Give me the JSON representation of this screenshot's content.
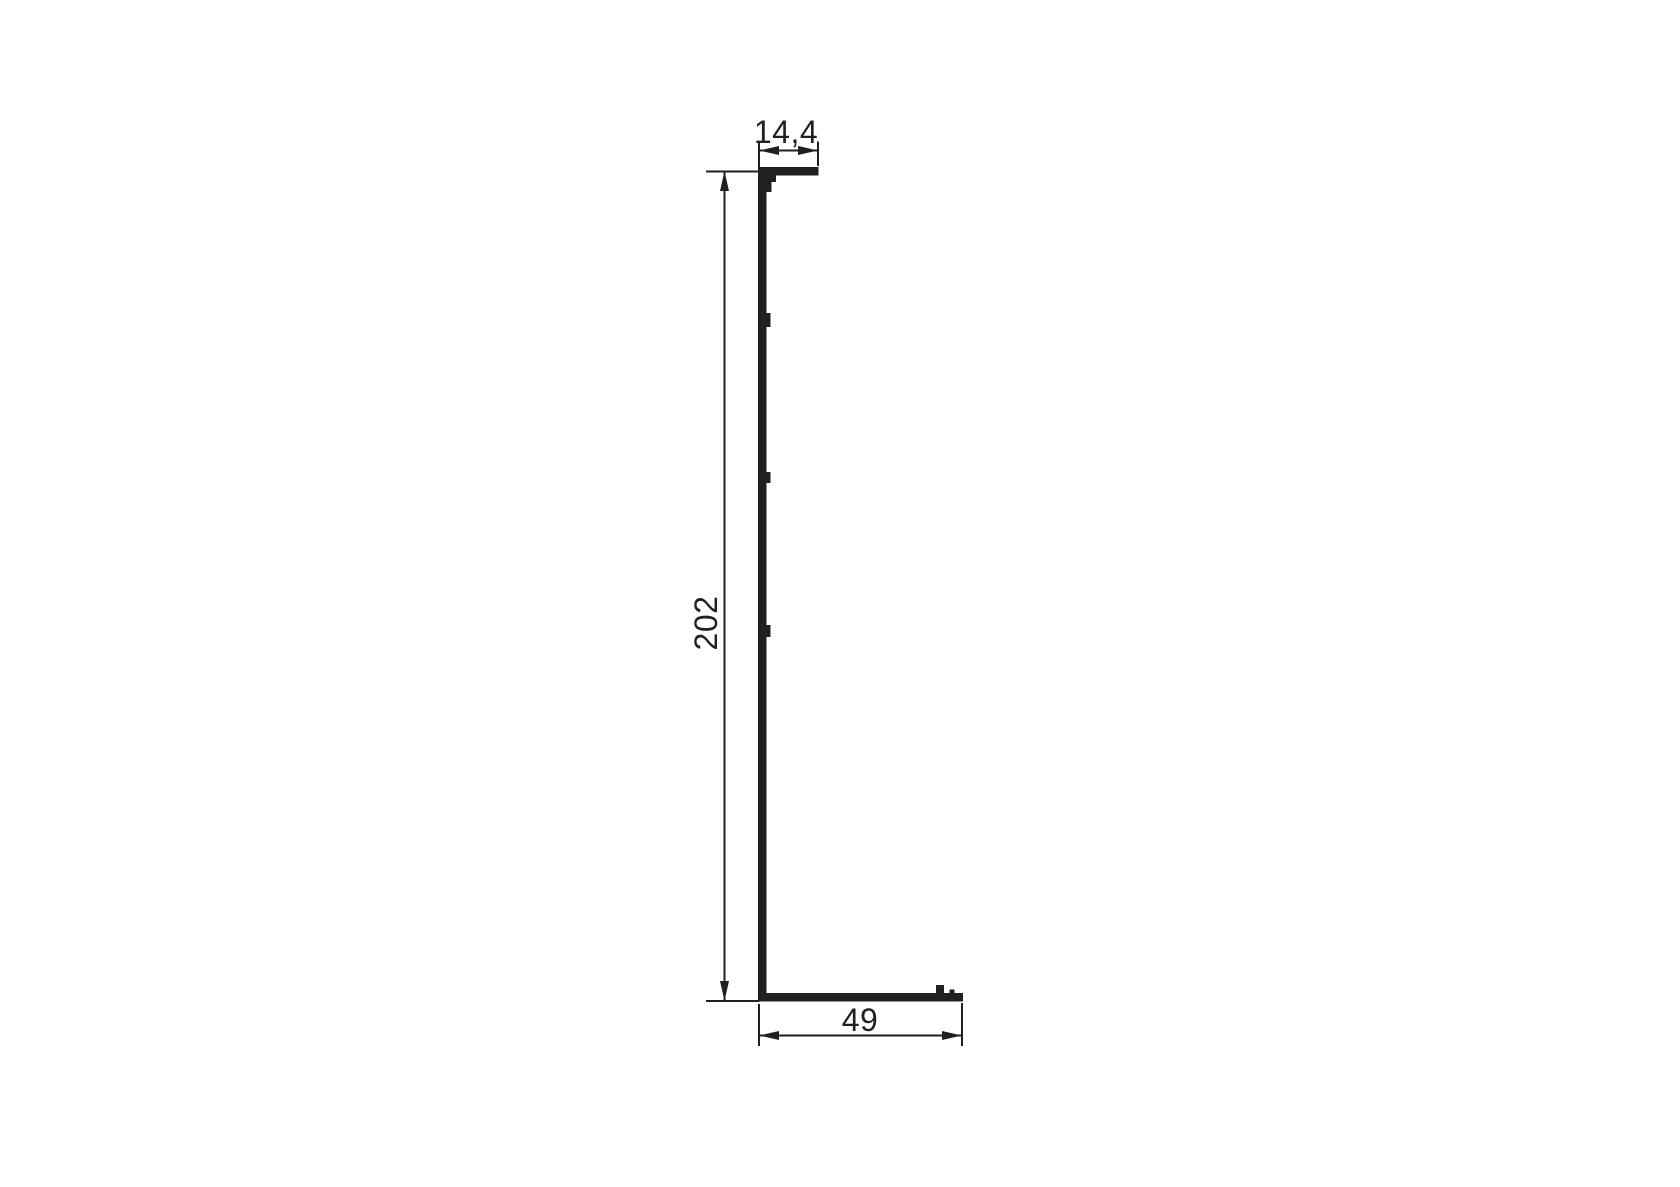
{
  "drawing": {
    "kind": "profile-cross-section-dimension-drawing",
    "background_color": "#ffffff",
    "ink_color": "#231f20",
    "dimensions": {
      "top_flange_width": {
        "label": "14,4"
      },
      "overall_height": {
        "label": "202"
      },
      "bottom_flange_width": {
        "label": "49"
      }
    }
  }
}
